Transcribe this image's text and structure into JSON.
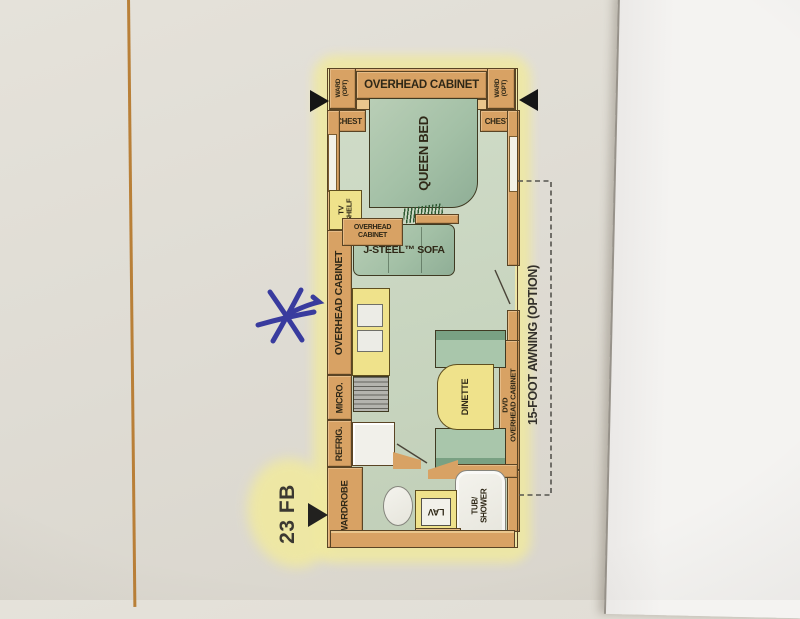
{
  "labels": {
    "model": "23 FB",
    "awning": "15-FOOT AWNING (OPTION)",
    "overhead_cabinet_top": "OVERHEAD CABINET",
    "ward_l1": "WARD",
    "ward_l2": "(OPT)",
    "chest": "CHEST",
    "queen_bed": "QUEEN BED",
    "tv_l1": "TV",
    "tv_l2": "SHELF",
    "overhead_small_l1": "OVERHEAD",
    "overhead_small_l2": "CABINET",
    "sofa": "J-STEEL™ SOFA",
    "overhead_wall": "OVERHEAD CABINET",
    "micro": "MICRO.",
    "refrig": "REFRIG.",
    "wardrobe": "WARDROBE",
    "dinette": "DINETTE",
    "dvd_l1": "DVD",
    "dvd_l2": "OVERHEAD CABINET",
    "tub_l1": "TUB/",
    "tub_l2": "SHOWER",
    "lav": "LAV",
    "med_cab": "MED. CAB."
  },
  "colors": {
    "wall": "#d8a264",
    "floor": "#c9d6c0",
    "furniture_green": "#a3c0a6",
    "counter_yellow": "#efe28b",
    "highlight": "#f0e9a0",
    "pen_blue": "#2b2e9a",
    "orange_line": "#b5772a",
    "paper": "#dfdcd4",
    "overlay_paper": "#f3f1ef"
  }
}
